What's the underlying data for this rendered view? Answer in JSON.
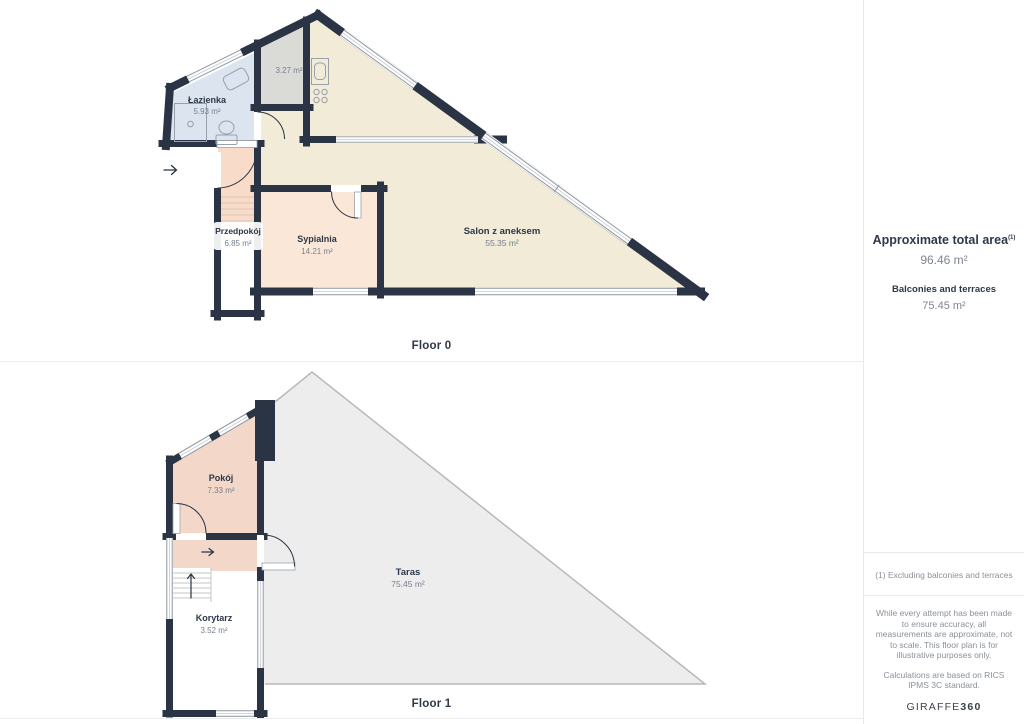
{
  "floor0": {
    "label": "Floor 0",
    "rooms": {
      "lazienka": {
        "name": "Łazienka",
        "area": "5.93 m²"
      },
      "garderoba": {
        "area": "3.27 m²"
      },
      "przedpokoj": {
        "name": "Przedpokój",
        "area": "6.85 m²"
      },
      "sypialnia": {
        "name": "Sypialnia",
        "area": "14.21 m²"
      },
      "salon": {
        "name": "Salon z aneksem",
        "area": "55.35 m²"
      }
    }
  },
  "floor1": {
    "label": "Floor 1",
    "rooms": {
      "pokoj": {
        "name": "Pokój",
        "area": "7.33 m²"
      },
      "taras": {
        "name": "Taras",
        "area": "75.45 m²"
      },
      "korytarz": {
        "name": "Korytarz",
        "area": "3.52 m²"
      }
    }
  },
  "sidebar": {
    "total_area_label": "Approximate total area",
    "total_area_note_marker": "(1)",
    "total_area_value": "96.46 m²",
    "balconies_label": "Balconies and terraces",
    "balconies_value": "75.45 m²",
    "footnote": "(1) Excluding balconies and terraces",
    "disclaimer": "While every attempt has been made to ensure accuracy, all measurements are approximate, not to scale. This floor plan is for illustrative purposes only.",
    "standard_note": "Calculations are based on RICS IPMS 3C standard.",
    "brand_name": "GIRAFFE",
    "brand_suffix": "360"
  },
  "colors": {
    "wall": "#2a3444",
    "salon": "#f1ebd7",
    "bathroom": "#dce4ef",
    "storage": "#dadad7",
    "bedroom": "#fbe7d8",
    "hallway": "#f8dcc9",
    "room_floor1": "#f3d7c8",
    "terrace": "#ededed",
    "label_dark": "#2c3747",
    "label_gray": "#76808f"
  }
}
